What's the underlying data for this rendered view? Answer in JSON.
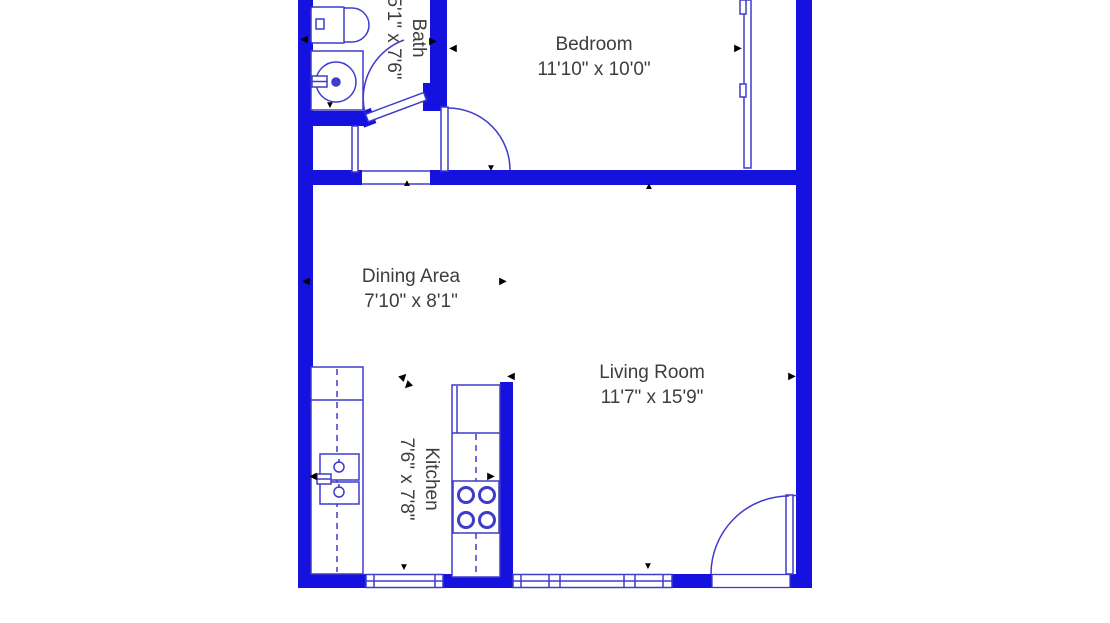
{
  "colors": {
    "wall": "#1512df",
    "line": "#3f3bcb",
    "text": "#3d3d3d",
    "arrow": "#000000"
  },
  "rooms": {
    "bath": {
      "label": "Bath",
      "dims": "5'1\" x 7'6\""
    },
    "bedroom": {
      "label": "Bedroom",
      "dims": "11'10\" x 10'0\""
    },
    "dining": {
      "label": "Dining Area",
      "dims": "7'10\" x 8'1\""
    },
    "kitchen": {
      "label": "Kitchen",
      "dims": "7'6\" x 7'8\""
    },
    "living": {
      "label": "Living Room",
      "dims": "11'7\" x 15'9\""
    }
  },
  "arrows": {
    "left": "◀",
    "right": "▶",
    "up": "▲",
    "down": "▼",
    "ne": "▶",
    "sw": "◀"
  }
}
